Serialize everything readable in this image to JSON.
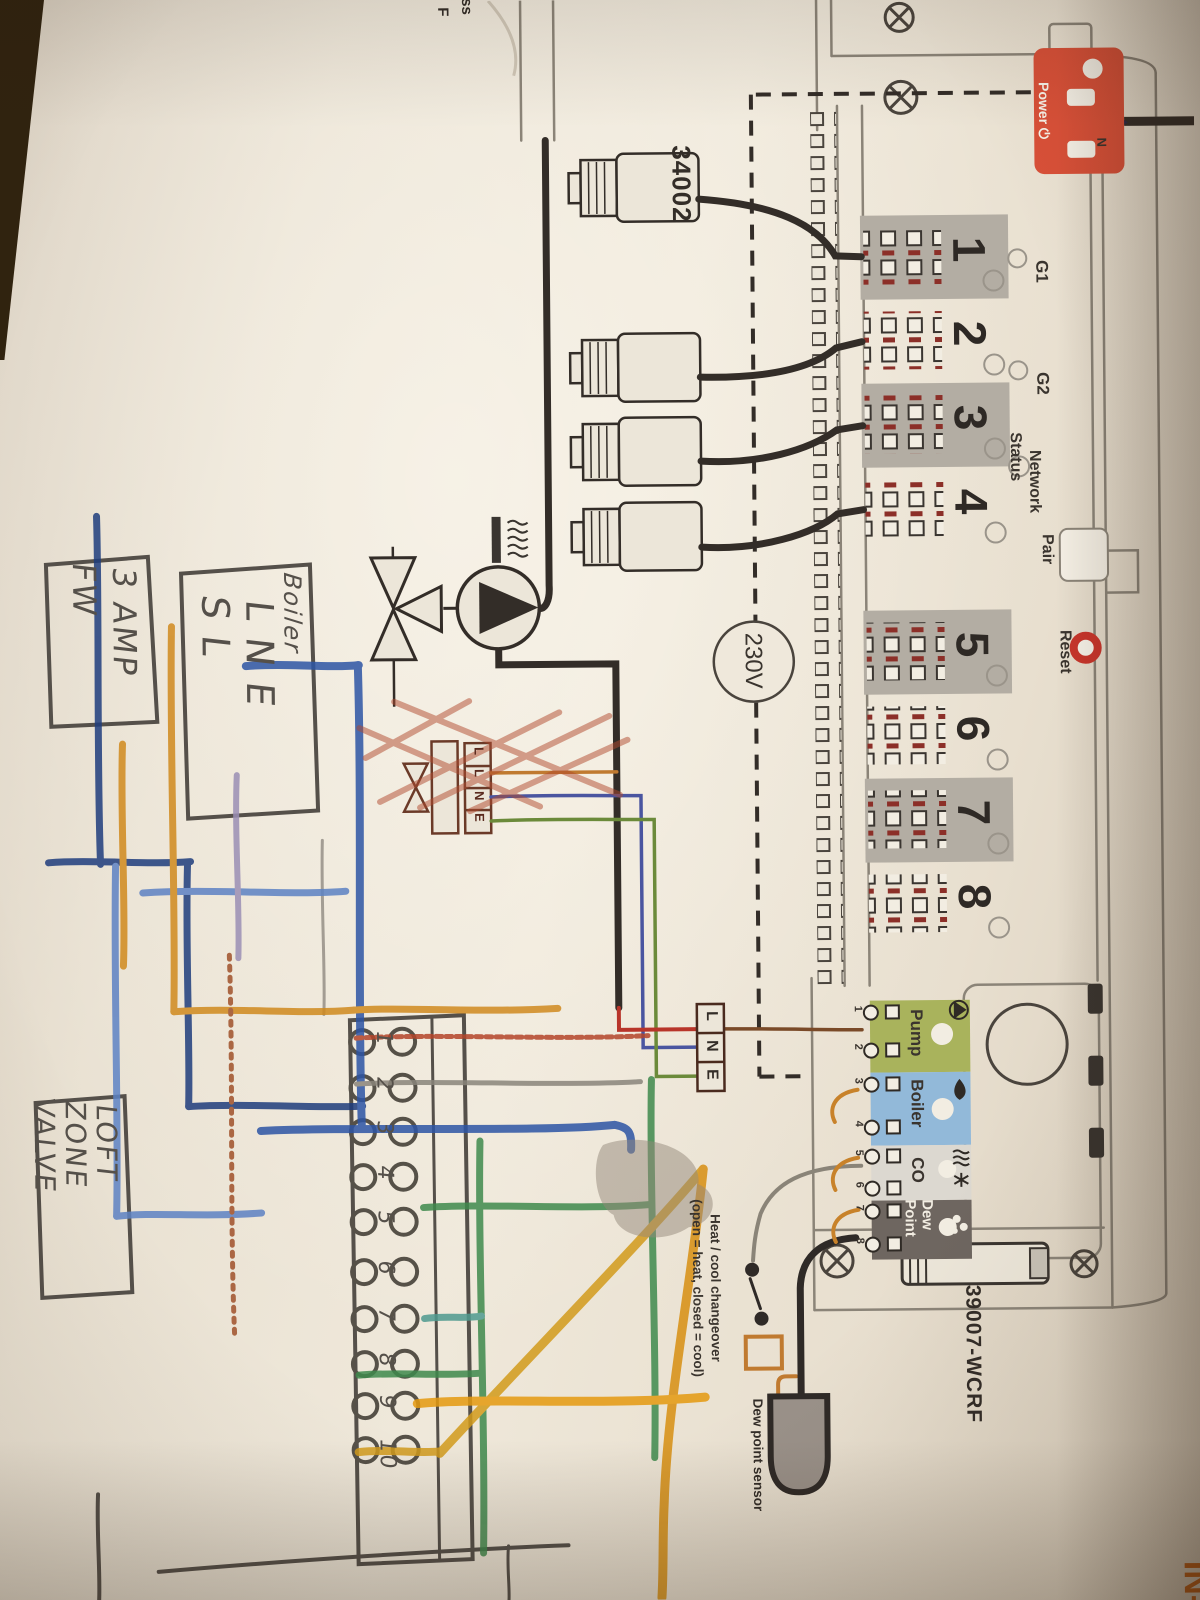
{
  "photo": {
    "edge_text_top": "ss",
    "edge_text_top2": "F",
    "corner_text_bottom_right": "IN-2"
  },
  "printed": {
    "actuator_model": "34002",
    "voltage": "230V",
    "model": "39007-WCRF",
    "power_label": "Power ⏻",
    "power_n": "N",
    "g1": "G1",
    "g2": "G2",
    "network_status_1": "Network",
    "network_status_2": "Status",
    "pair": "Pair",
    "reset": "Reset",
    "zones": [
      "1",
      "2",
      "3",
      "4",
      "5",
      "6",
      "7",
      "8"
    ],
    "outputs": {
      "pump": "Pump",
      "boiler": "Boiler",
      "co": "CO",
      "dew_1": "Dew",
      "dew_2": "Point"
    },
    "output_terminals": [
      "1",
      "2",
      "3",
      "4",
      "5",
      "6",
      "7",
      "8"
    ],
    "mains": {
      "l": "L",
      "n": "N",
      "e": "E"
    },
    "valve_block": [
      "L",
      "L",
      "N",
      "E"
    ],
    "changeover_1": "Heat / cool changeover",
    "changeover_2": "(open = heat, closed = cool)",
    "dew_sensor": "Dew point sensor"
  },
  "handwritten": {
    "fuse_1": "3 AMP",
    "fuse_2": "FW",
    "boiler_title": "Boiler",
    "boiler_l1": "L N E",
    "boiler_l2": "S L",
    "valve_1": "LOFT",
    "valve_2": "ZONE",
    "valve_3": "VALVE",
    "strip": [
      "1",
      "2",
      "3",
      "4",
      "5",
      "6",
      "7",
      "8",
      "9",
      "10"
    ]
  },
  "colors": {
    "power_red": "#d85038",
    "reset_red": "#c8352b",
    "pump_olive": "#a9b35c",
    "boiler_blue": "#92b9d9",
    "co_grey": "#dcd8d0",
    "dew_grey": "#6e6660",
    "crayon_blue": "#2d55a5",
    "crayon_green": "#3f8a4d",
    "crayon_orange": "#d08a1e",
    "pencil": "#55504a"
  }
}
